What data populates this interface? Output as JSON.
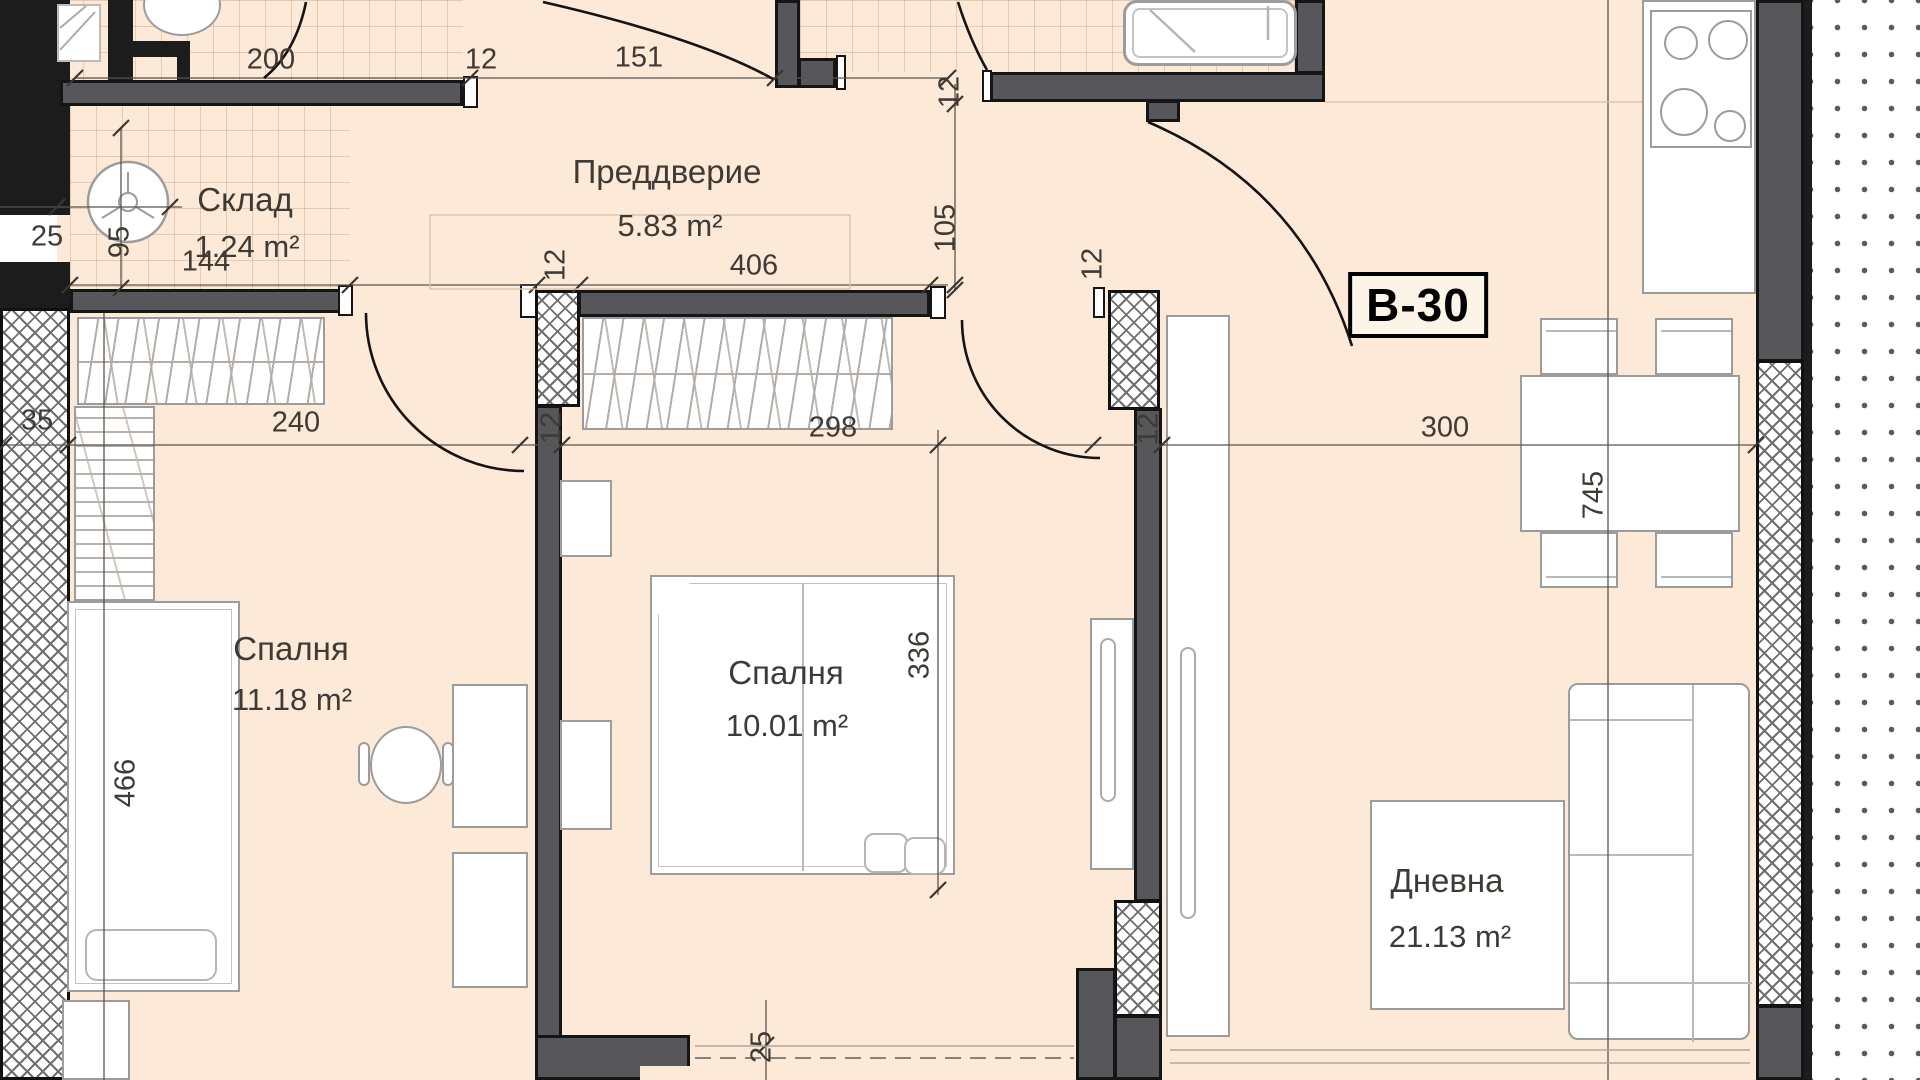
{
  "unit_label": "B-30",
  "rooms": [
    {
      "name": "Склад",
      "area": "1.24 m²"
    },
    {
      "name": "Преддверие",
      "area": "5.83 m²"
    },
    {
      "name": "Спалня",
      "area": "11.18 m²"
    },
    {
      "name": "Спалня",
      "area": "10.01 m²"
    },
    {
      "name": "Дневна",
      "area": "21.13 m²"
    }
  ],
  "labels": {
    "unit": "B-30",
    "r1n": "Склад",
    "r1a": "1.24 m²",
    "r2n": "Преддверие",
    "r2a": "5.83 m²",
    "r3n": "Спалня",
    "r3a": "11.18 m²",
    "r4n": "Спалня",
    "r4a": "10.01 m²",
    "r5n": "Дневна",
    "r5a": "21.13 m²",
    "d200": "200",
    "d12_top": "12",
    "d151": "151",
    "d144": "144",
    "d406": "406",
    "d12_ul": "12",
    "d12_ur": "12",
    "d35": "35",
    "d240": "240",
    "d12_ml": "12",
    "d298": "298",
    "d12_mr": "12",
    "d300": "300",
    "d25_top": "25",
    "d95": "95",
    "d105": "105",
    "d12_v": "12",
    "d466": "466",
    "d336": "336",
    "d745": "745",
    "d25_bot": "25"
  }
}
